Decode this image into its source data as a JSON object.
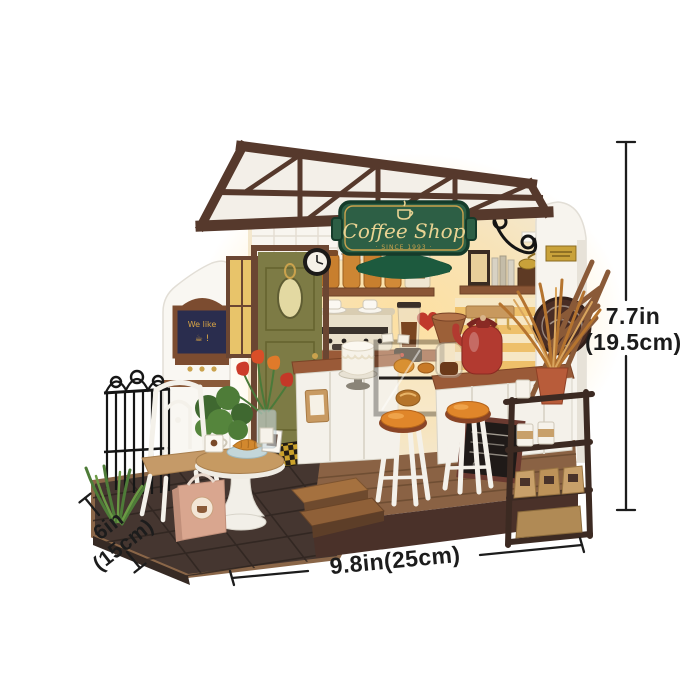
{
  "sign": {
    "title": "Coffee Shop",
    "subtitle": "· SINCE 1993 ·"
  },
  "chalkboard": {
    "line1": "We like",
    "line2": "☕ !"
  },
  "door_tag": "while",
  "annotations": {
    "height": {
      "line1": "7.7in",
      "line2": "(19.5cm)"
    },
    "width": {
      "label": "9.8in(25cm)"
    },
    "depth": {
      "line1": "6in",
      "line2": "(15cm)"
    }
  },
  "colors": {
    "roof_brown": "#56392c",
    "sign_green": "#2d5f45",
    "sign_gold": "#e9d393",
    "door_olive": "#7d7b45",
    "kettle_red": "#b23a30",
    "stool_orange": "#e0862a",
    "counter_wood": "#9a5a38",
    "base_dark": "#4a3129",
    "dimension_ink": "#1c1c1c"
  }
}
